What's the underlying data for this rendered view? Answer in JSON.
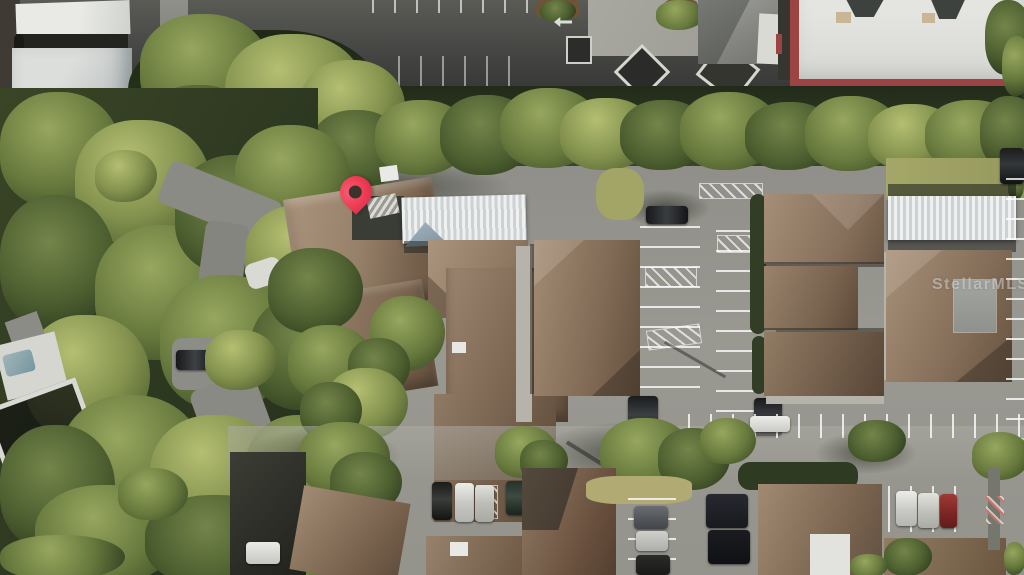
{
  "scene": {
    "description_label": "aerial-photo-of-condo-community",
    "marker_count": 1
  },
  "watermark": {
    "text": "StellarMLS"
  },
  "map_pin": {
    "color": "#ee3b53",
    "tip_x": 356,
    "tip_y": 217
  },
  "palette": {
    "asphalt": "#91908a",
    "asphalt-dark": "#43443f",
    "roof-light": "#a8927b",
    "roof-mid": "#8d7762",
    "roof-dark": "#6b5745",
    "tree-light": "#b5bf72",
    "tree-mid": "#66783c",
    "tree-dark": "#2b381e",
    "carport-white": "#eff1f1",
    "building-white": "#e2e3df",
    "red-trim": "#9c4343",
    "pin-red": "#ee3b53",
    "grass": "#a2a566",
    "concrete": "#b5b3aa"
  }
}
